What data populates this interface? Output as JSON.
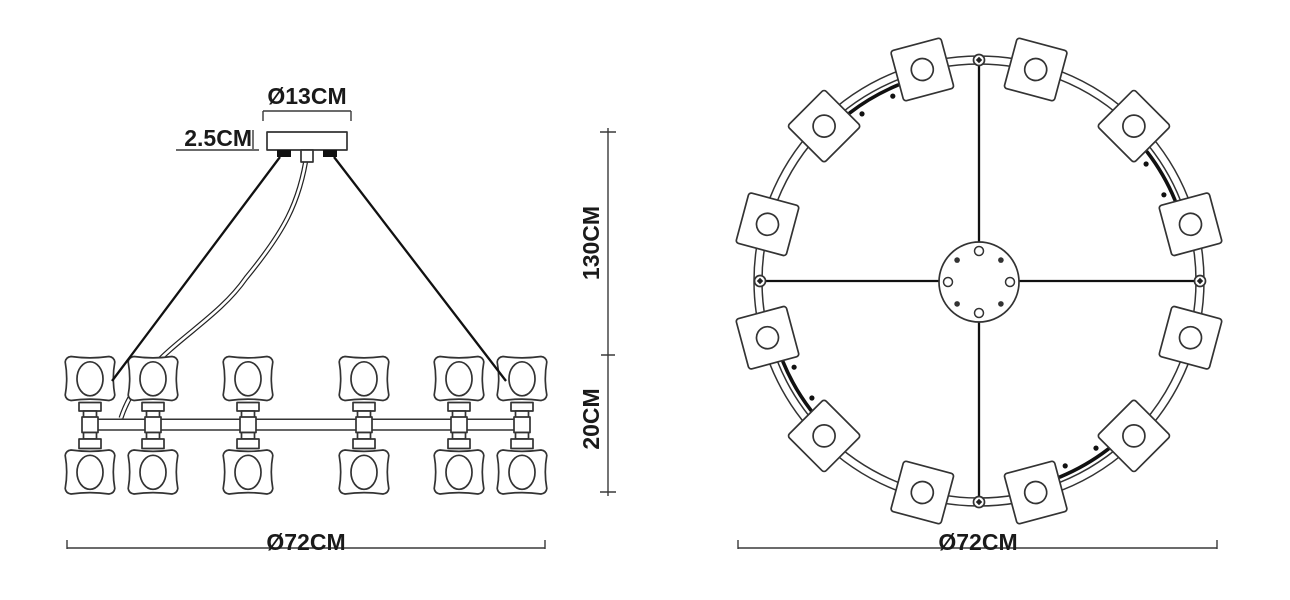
{
  "drawing": {
    "title": "chandelier-dimension-drawing",
    "background": "#ffffff",
    "line_color": "#333333",
    "text_color": "#1a1a1a"
  },
  "side_view": {
    "dim_canopy_diameter": "Ø13CM",
    "dim_canopy_height": "2.5CM",
    "dim_suspension_height": "130CM",
    "dim_body_height": "20CM",
    "dim_overall_diameter": "Ø72CM",
    "lamp_columns": 6,
    "lamps_per_column": 2
  },
  "top_view": {
    "dim_overall_diameter": "Ø72CM",
    "shade_count": 12,
    "shade_shape": "square",
    "canopy_hole_count": 8
  }
}
